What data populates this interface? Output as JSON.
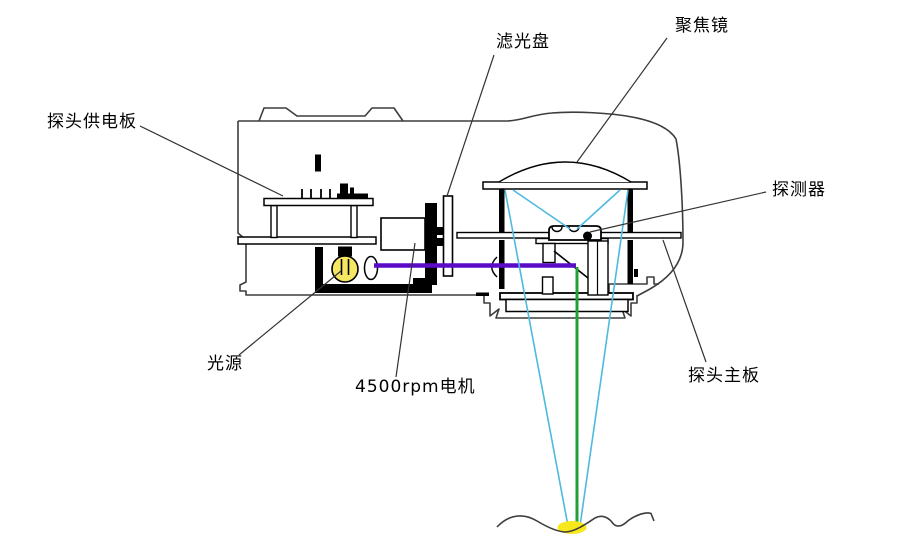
{
  "diagram": {
    "labels": {
      "power_board": "探头供电板",
      "filter_disk": "滤光盘",
      "focus_lens": "聚焦镜",
      "detector": "探测器",
      "light_source": "光源",
      "motor": "4500rpm电机",
      "main_board": "探头主板"
    },
    "colors": {
      "illumination_beam": "#5B0BC8",
      "return_beam": "#21A038",
      "collection_ray": "#4FBADF",
      "lamp": "#F5E763",
      "focal_spot": "#F8E71C"
    }
  }
}
